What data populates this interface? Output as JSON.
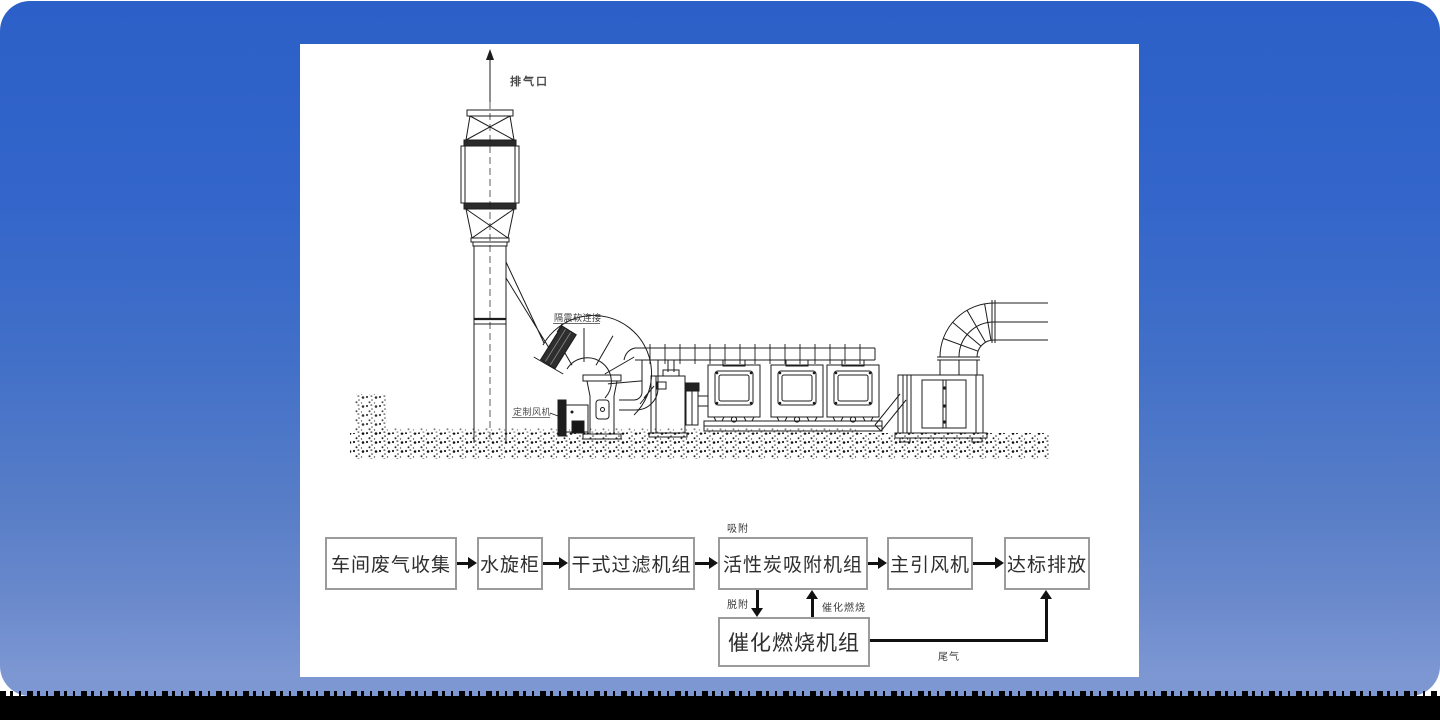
{
  "window": {
    "background_top_color": "#2c60c8",
    "background_bottom_color": "#7d97d3",
    "footer_band_color": "#000000",
    "panel_color": "#ffffff"
  },
  "diagram": {
    "labels": {
      "exhaust_outlet": "排气口",
      "vibration_flex_joint": "隔震软连接",
      "custom_fan": "定制风机"
    },
    "line_color": "#1c1c1c"
  },
  "flowchart": {
    "boxes": [
      {
        "label": "车间废气收集"
      },
      {
        "label": "水旋柜"
      },
      {
        "label": "干式过滤机组"
      },
      {
        "label": "活性炭吸附机组"
      },
      {
        "label": "主引风机"
      },
      {
        "label": "达标排放"
      },
      {
        "label": "催化燃烧机组"
      }
    ],
    "edge_labels": {
      "adsorb": "吸附",
      "desorb": "脱附",
      "catalytic_combustion": "催化燃烧",
      "tail_gas": "尾气"
    },
    "box_border_color": "#9b9b9b",
    "arrow_color": "#111111"
  }
}
